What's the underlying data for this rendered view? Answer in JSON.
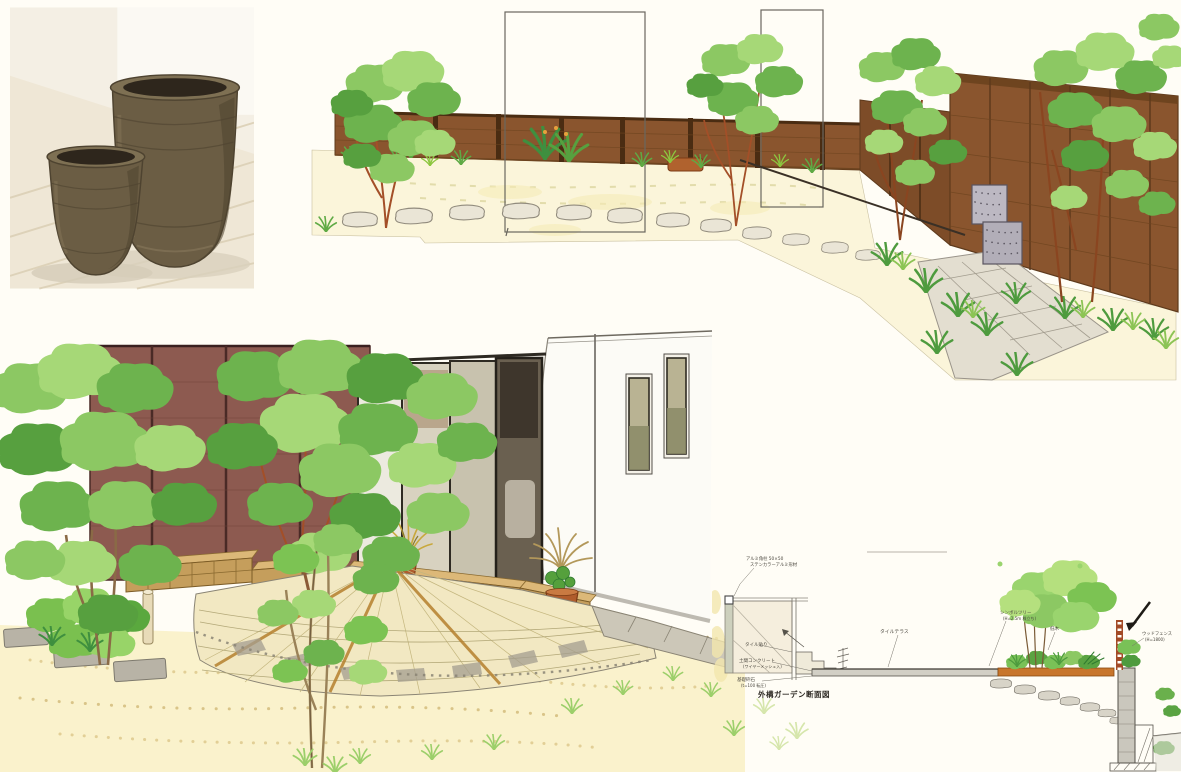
{
  "page": {
    "background": "#fffdf6",
    "kind": "hand-drawn landscape garden design presentation scan"
  },
  "photo": {
    "subject": "two ceramic garden pots on wooden floor",
    "colors": {
      "floor": "#f1eadb",
      "plank": "#dbcfb4",
      "pot_body": "#6b5d44",
      "pot_rim": "#7e7053",
      "pot_inner": "#2e261c",
      "pot_shade": "#4e4330",
      "cast_shadow": "#d9d1bd"
    }
  },
  "garden_sketch": {
    "subject": "garden perspective with wood fence, trees, stepping stone path and stone water feature",
    "colors": {
      "ground": "#fbf5da",
      "fence": "#8a552e",
      "fence_mid": "#7d4c28",
      "fence_dark": "#4a2c12",
      "foliage1": "#8cc863",
      "foliage2": "#6db34e",
      "foliage3": "#a6d877",
      "foliage4": "#57a03f",
      "branch": "#a34f28",
      "stone": "#eae5d6",
      "stone_edge": "#918b7d",
      "pave": "#e3ded0",
      "cube": "#bcb8c2",
      "cube_dot": "#5a5560",
      "flower_blue": "#5b8cc8",
      "grass": "#5faa45",
      "brick": "#b0622e"
    }
  },
  "house_sketch": {
    "subject": "courtyard perspective with maroon panel wall, white house corner, brick planters and fan-shaped tile terrace",
    "colors": {
      "maroon": "#8d5a50",
      "maroon_joint": "#4a2a26",
      "white_wall": "#fcfbf6",
      "frame": "#2e2a22",
      "glass_light": "#eceadf",
      "glass_mid": "#c8c2ae",
      "glass_dark": "#6a6050",
      "window_glass": "#8a8a66",
      "brick": "#c59e5c",
      "brick_top": "#dcb878",
      "brick_joint": "#8a6a30",
      "tile": "#f2e8c2",
      "tile_line": "#b3a878",
      "tile_gray": "#a49e90",
      "deck_strip": "#b5802e",
      "walk": "#ccc7b8",
      "ground": "#faf1c8",
      "stipple": "#e2cf96",
      "pot": "#b05c2c",
      "grass_plant": "#c8a83c",
      "paver": "#b8b3a6"
    }
  },
  "section": {
    "title": "外構ガーデン断面図",
    "labels": {
      "post_1": "アルミ角柱 50×50",
      "post_2": "ステンカラーアルミ形材",
      "tile": "タイル貼り",
      "slab": "土間コンクリート",
      "slab_sub": "(ワイヤーメッシュ入)",
      "base": "基礎砕石",
      "base_sub": "(t=100 転圧)",
      "terrace": "タイルテラス",
      "tree_1": "シンボルツリー",
      "tree_2": "(H=2.5m 株立ち)",
      "shrub": "低木",
      "fence_1": "ウッドフェンス",
      "fence_2": "(H=1800)"
    },
    "colors": {
      "line": "#55524a",
      "text": "#4a463e",
      "slab": "#d2cfc5",
      "planter": "#c8762c",
      "wall": "#cac7bd",
      "fence": "#a34a26",
      "stone": "#d8d4c8",
      "panel": "#f5eedd"
    }
  }
}
